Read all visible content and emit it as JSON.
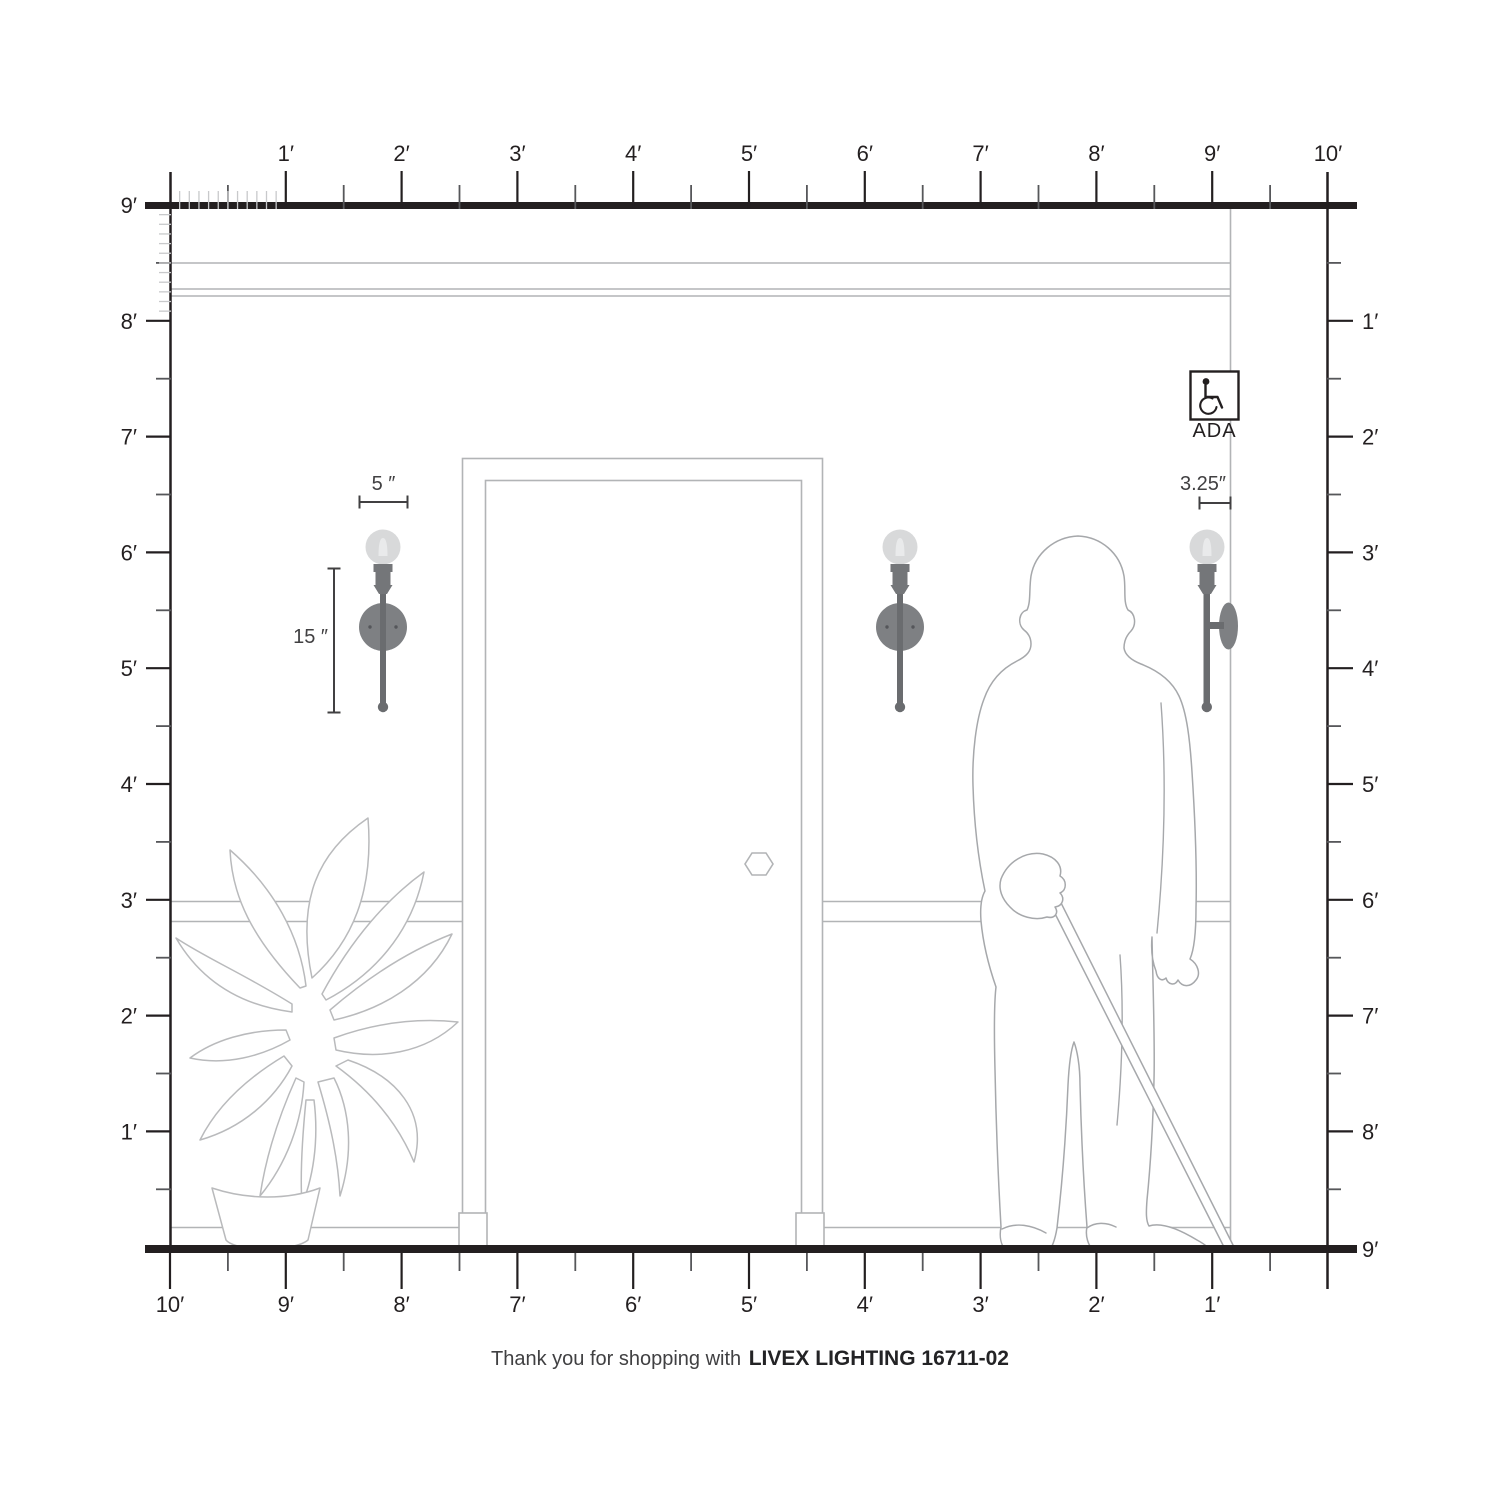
{
  "page": {
    "background": "#ffffff"
  },
  "rulers": {
    "unit": "feet",
    "top": {
      "labels": [
        "1′",
        "2′",
        "3′",
        "4′",
        "5′",
        "6′",
        "7′",
        "8′",
        "9′",
        "10′"
      ]
    },
    "left": {
      "labels": [
        "9′",
        "8′",
        "7′",
        "6′",
        "5′",
        "4′",
        "3′",
        "2′",
        "1′"
      ]
    },
    "right": {
      "labels": [
        "1′",
        "2′",
        "3′",
        "4′",
        "5′",
        "6′",
        "7′",
        "8′"
      ],
      "floor_label": "9′"
    },
    "bottom": {
      "labels": [
        "10′",
        "9′",
        "8′",
        "7′",
        "6′",
        "5′",
        "4′",
        "3′",
        "2′",
        "1′"
      ]
    }
  },
  "annotations": {
    "width_label": "5 ″",
    "height_label": "15 ″",
    "depth_label": "3.25″"
  },
  "ada": {
    "label": "ADA"
  },
  "footer": {
    "prefix": "Thank you for shopping with ",
    "brand": "LIVEX LIGHTING 16711-02"
  },
  "colors": {
    "ink": "#231f20",
    "line_light": "#b2b4b6",
    "silhouette": "#a6a8ab",
    "plant": "#b9babc",
    "bulb": "#d8d9da",
    "socket": "#747679",
    "backplate": "#7e8083",
    "stem": "#6a6c6f",
    "dimension": "#414042"
  }
}
